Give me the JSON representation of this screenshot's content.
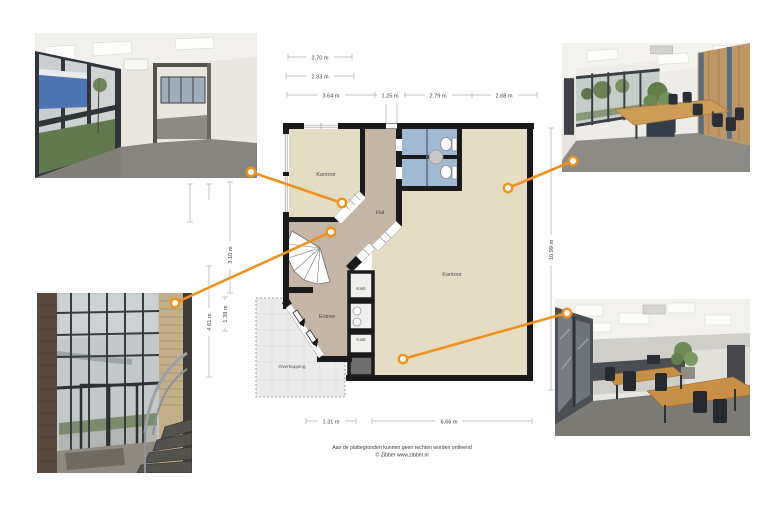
{
  "plan": {
    "room_labels": {
      "kantoor_left": "Kantoor",
      "hal": "Hal",
      "kantoor_right": "Kantoor",
      "entree": "Entree",
      "kast_top": "Kast",
      "kast_bottom": "Kast",
      "overkapping": "Overkapping"
    },
    "dimensions": {
      "top_row1": "2.70 m",
      "top_row2": "2.83 m",
      "top_w1": "3.64 m",
      "top_w2": "1.25 m",
      "top_w3": "2.79 m",
      "top_w4": "2.68 m",
      "left_h1": "3.10 m",
      "left_h2": "1.39 m",
      "left_h3": "4.61 m",
      "right_h": "10.99 m",
      "bottom_w1": "1.31 m",
      "bottom_w2": "6.66 m"
    },
    "colors": {
      "room_floor": "#e5ddc3",
      "hall_floor": "#c4b5a4",
      "wet_floor": "#a0b9d4",
      "closet_floor": "#efefed",
      "wall": "#1a1a1a",
      "connector": "#f0911f",
      "overkapping_fill": "#ebebeb"
    }
  },
  "photos": {
    "top_left": "office-room-with-window-wall",
    "top_right": "conference-room",
    "bottom_left": "entrance-stairwell",
    "bottom_right": "office-with-desks"
  },
  "footer": {
    "disclaimer": "Aan de plattegronden kunnen geen rechten worden ontleend",
    "credit": "© Zibber www.zibber.nl"
  }
}
